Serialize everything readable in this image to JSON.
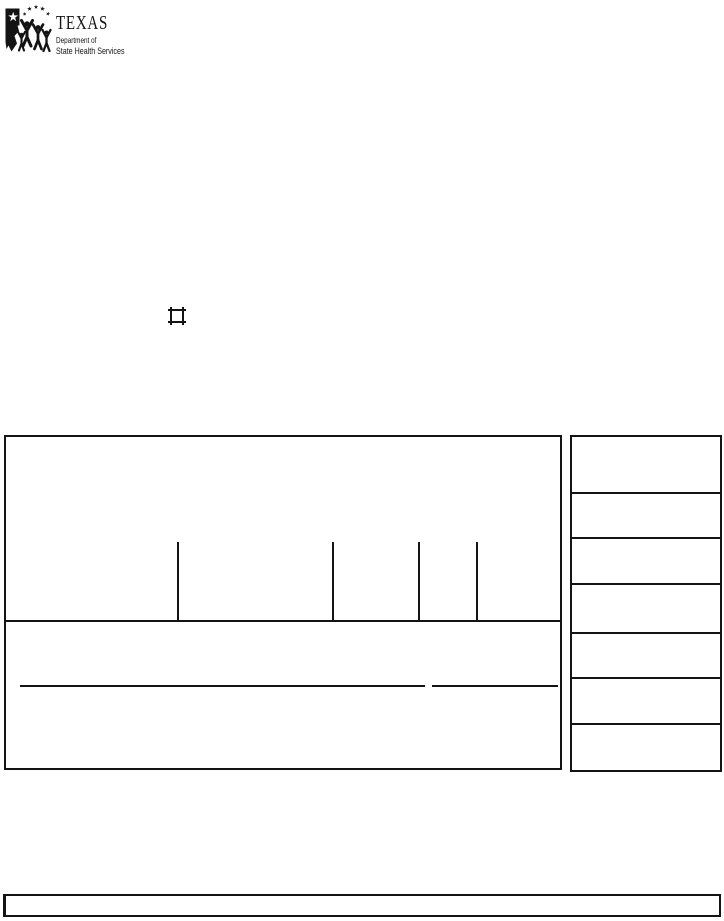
{
  "colors": {
    "ink": "#141414",
    "paper": "#ffffff"
  },
  "logo": {
    "icon": "texas-dshs-logo",
    "title": "TEXAS",
    "dept_line": "Department of",
    "agency_line": "State Health Services"
  },
  "form": {
    "checkbox": {
      "checked": false
    },
    "fields": {
      "signature_line_value": "",
      "date_line_value": "",
      "footer_value": ""
    },
    "side_panel": {
      "row_count": 7
    }
  }
}
